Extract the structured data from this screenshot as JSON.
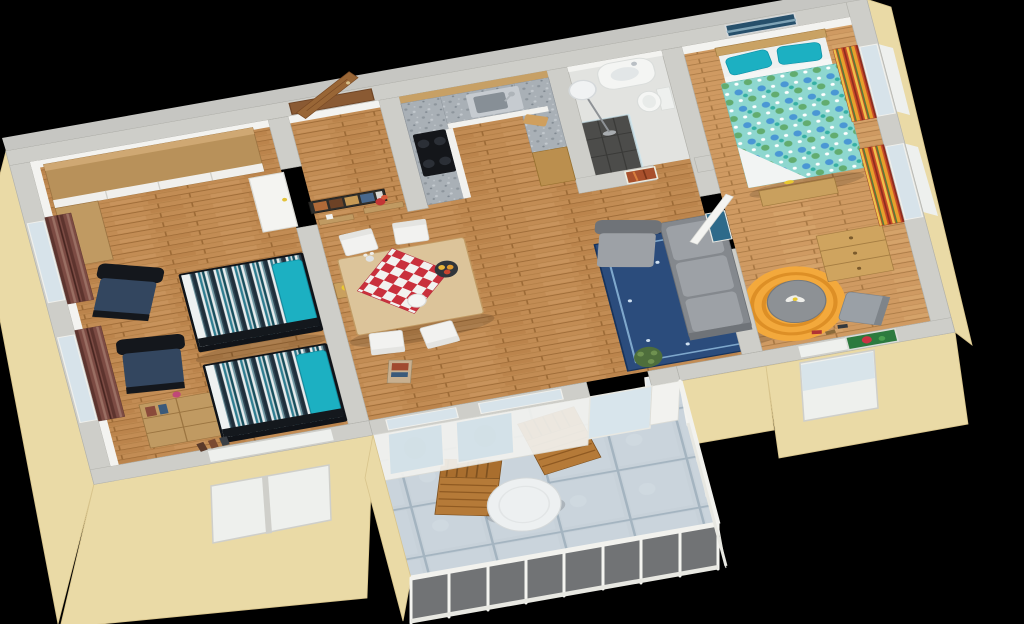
{
  "scene": {
    "type": "3d-floorplan-render",
    "view": "isometric overhead 3/4 view",
    "description": "3D rendered floor plan of a two-bedroom apartment with balcony on a black background",
    "background_color": "#000000"
  },
  "colors": {
    "bg": "#000000",
    "wall-top": "#cecec9",
    "wall-edge": "#b2b2ac",
    "wall-white": "#f3f3f0",
    "stucco": "#eadaa6",
    "stucco-dark": "#d8c48c",
    "glass": "#d7e3ea",
    "white": "#f4f5f3",
    "granite": "#a9b0b6",
    "cooktop": "#14161a",
    "steel": "#c6cbd0",
    "furniture-wood": "#c09a62",
    "furniture-wood-dark": "#9c7442",
    "headboard": "#c9a264",
    "door-brown": "#8a5a33",
    "navy-chair": "#33465f",
    "chair-frame": "#14171c",
    "pillow-teal": "#1cb0c2",
    "sofa": "#84888d",
    "sofa-cushion": "#9da1a6",
    "rug-blue": "#2b4c7c",
    "rug-border": "#7fa8cc",
    "rug-orange": "#f3a93c",
    "rug-orange-ring": "#dd8f26",
    "shower": "#4c4c4a",
    "plant": "#57693f",
    "plant-light": "#7d9b5c",
    "sea-pic": "#27506b",
    "green-pic": "#2c7a3e",
    "canyon-pic": "#a8502c",
    "table-white": "#edf0f1",
    "deck-wood": "#ab7030",
    "deck-wood-dark": "#7e5120",
    "wood-floor": "#c28c54",
    "wood-floor-line": "#9c6a36",
    "wood-floor-master": "#cf9a62",
    "balcony-tile": "#c7d1d9",
    "balcony-tile-line": "#a4b4c0",
    "cloth-red": "#c9303c",
    "curtain-maroon": "#7c4b43",
    "curtain-red": "#c84a28",
    "curtain-gold": "#e8a02c",
    "duvet-teal": "#8ed7cf",
    "duvet-dot": "#4a97d4",
    "bed-stripe-dark": "#1f2e3a",
    "bed-stripe-teal": "#2e7d91"
  },
  "rooms": [
    {
      "id": "kids-bedroom",
      "label": "Children's bedroom",
      "floor": "wood planks",
      "furniture": [
        "corner wardrobe with white sliding doors",
        "two single beds with blue striped covers and teal pillows",
        "two dark blue armchairs",
        "wooden cube shelf with flowers and shoes",
        "two windows with dark red striped curtains",
        "white room door"
      ]
    },
    {
      "id": "entrance-hall",
      "label": "Entrance hall",
      "floor": "wood planks",
      "furniture": [
        "brown front door standing open",
        "multi-photo picture frame",
        "two wooden wall shelves",
        "red flowers",
        "white cup"
      ]
    },
    {
      "id": "kitchen",
      "label": "Kitchen",
      "floor": "wood planks",
      "furniture": [
        "L-shaped granite counter",
        "black induction cooktop",
        "stainless steel sink",
        "white cabinet fronts",
        "tall wooden cabinet",
        "wood wall paneling",
        "cutting board"
      ]
    },
    {
      "id": "dining-area",
      "label": "Dining area",
      "floor": "wood planks",
      "furniture": [
        "light wood dining table",
        "red and white checkered tablecloth",
        "four white chairs",
        "fruit bowl",
        "flower vase",
        "white plate",
        "side table with yellow lamp",
        "magazine on floor"
      ]
    },
    {
      "id": "bathroom",
      "label": "Bathroom",
      "floor": "light tile",
      "furniture": [
        "curved white vanity with basin",
        "toilet",
        "dark tiled shower corner with glass panel",
        "floor lamp"
      ]
    },
    {
      "id": "hallway",
      "label": "Hallway",
      "floor": "wood planks",
      "furniture": [
        "canyon photograph on wall"
      ]
    },
    {
      "id": "living-area",
      "label": "Living area",
      "floor": "wood planks",
      "furniture": [
        "gray corner sofa",
        "gray armchair",
        "dark blue patterned rug",
        "potted plant",
        "glazed balcony door and windows",
        "tall landscape picture on wall"
      ]
    },
    {
      "id": "master-bedroom",
      "label": "Master bedroom",
      "floor": "wood planks",
      "furniture": [
        "double bed with two turquoise pillows and teal patterned duvet",
        "wooden headboard",
        "bed-end bench",
        "wooden chest of drawers",
        "round orange striped rug",
        "round gray table with white flower",
        "gray chair",
        "shoes",
        "seascape picture above bed",
        "green flower picture",
        "two windows with red-yellow striped bunched curtains",
        "white room door"
      ]
    },
    {
      "id": "balcony",
      "label": "Balcony",
      "floor": "blue-gray stone tiles",
      "furniture": [
        "two wooden slatted deck chairs",
        "round white table",
        "potted plant",
        "white balustrade railing with glass",
        "beige side wall"
      ]
    }
  ]
}
